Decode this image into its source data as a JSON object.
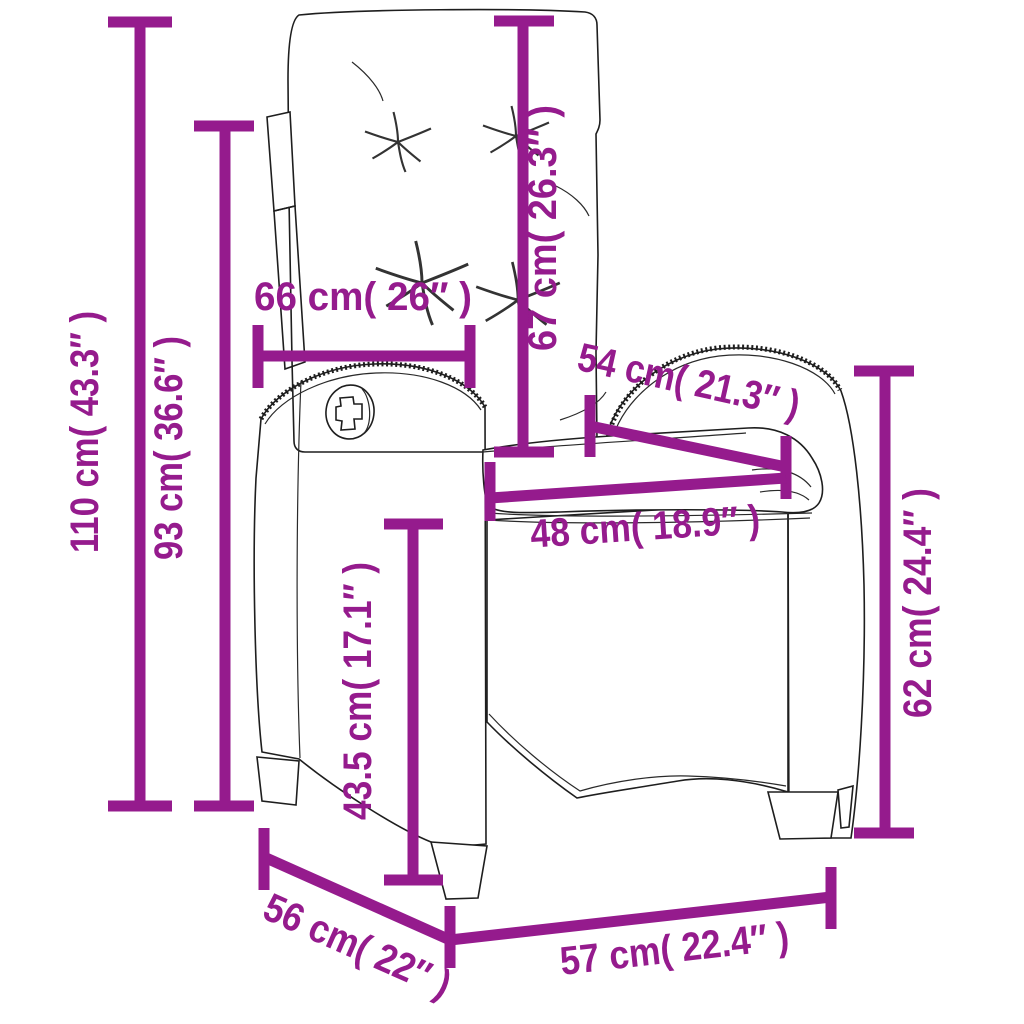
{
  "diagram": {
    "subject": "reclining-rattan-garden-chair-with-cushions",
    "accent_color": "#951B8D",
    "outline_color": "#1e1e1e",
    "background_color": "#ffffff",
    "dimensions": [
      {
        "id": "total-height",
        "value_cm": "110",
        "value_in": "43.3",
        "label": "110 cm( 43.3″ )"
      },
      {
        "id": "backrest-height",
        "value_cm": "93",
        "value_in": "36.6",
        "label": "93 cm( 36.6″ )"
      },
      {
        "id": "top-width",
        "value_cm": "66",
        "value_in": "26",
        "label": "66 cm( 26″ )"
      },
      {
        "id": "back-cushion-height",
        "value_cm": "67",
        "value_in": "26.3",
        "label": "67 cm( 26.3″ )"
      },
      {
        "id": "armrest-depth",
        "value_cm": "54",
        "value_in": "21.3",
        "label": "54 cm( 21.3″ )"
      },
      {
        "id": "seat-width",
        "value_cm": "48",
        "value_in": "18.9",
        "label": "48 cm( 18.9″ )"
      },
      {
        "id": "seat-height",
        "value_cm": "43.5",
        "value_in": "17.1",
        "label": "43.5 cm( 17.1″ )"
      },
      {
        "id": "side-height",
        "value_cm": "62",
        "value_in": "24.4",
        "label": "62 cm( 24.4″ )"
      },
      {
        "id": "base-depth",
        "value_cm": "56",
        "value_in": "22",
        "label": "56 cm( 22″ )"
      },
      {
        "id": "base-width",
        "value_cm": "57",
        "value_in": "22.4",
        "label": "57 cm( 22.4″ )"
      }
    ]
  }
}
